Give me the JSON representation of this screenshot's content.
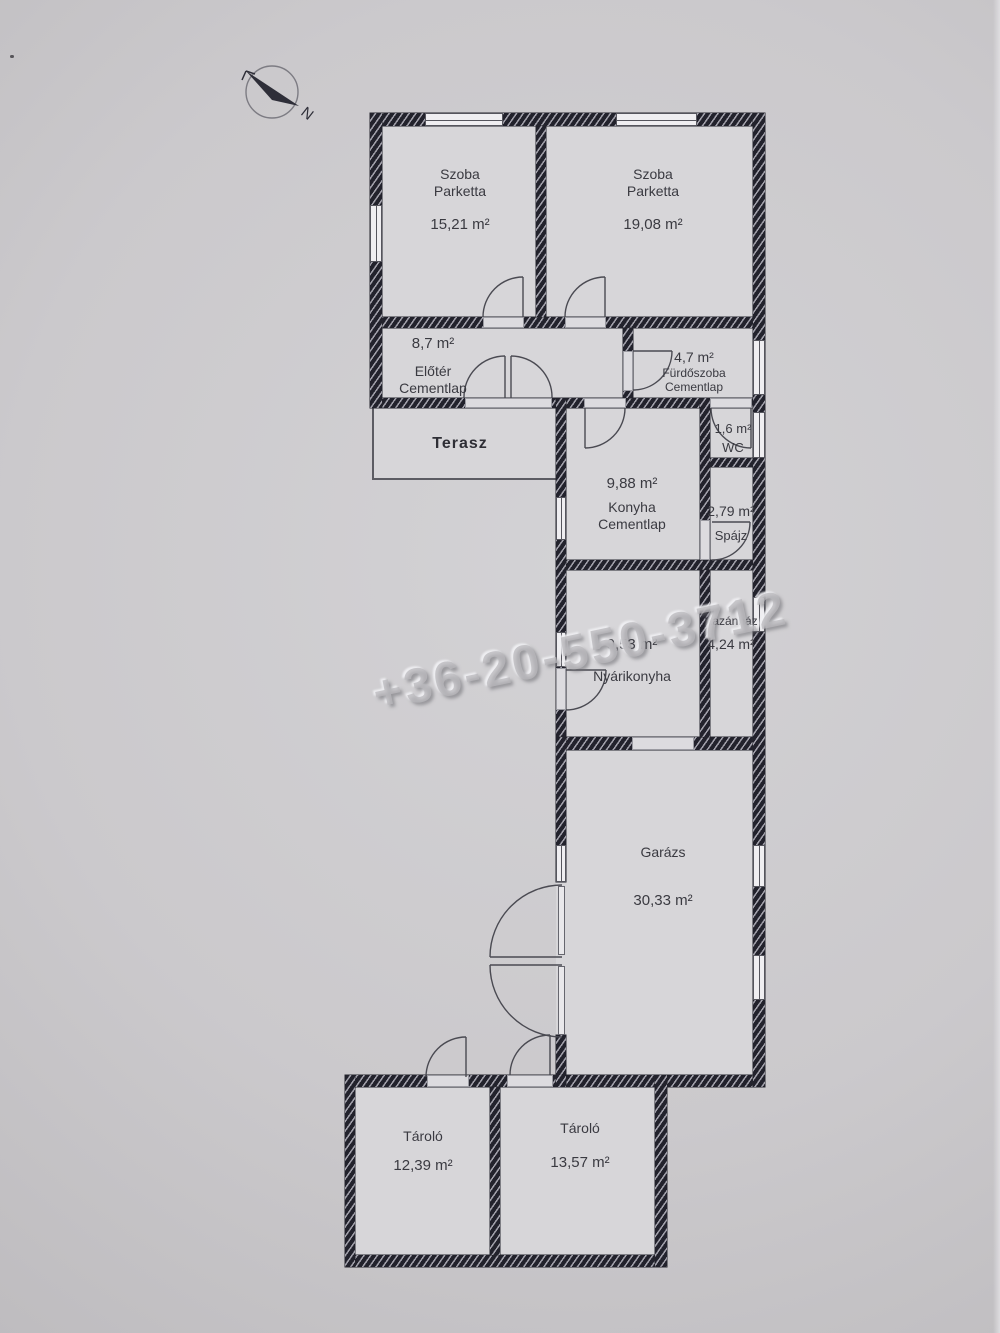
{
  "compass": {
    "label": "N"
  },
  "watermark": {
    "text": "+36-20-550-3712"
  },
  "rooms": {
    "szoba1": {
      "name": "Szoba",
      "floor": "Parketta",
      "area": "15,21 m²"
    },
    "szoba2": {
      "name": "Szoba",
      "floor": "Parketta",
      "area": "19,08 m²"
    },
    "eloter": {
      "area": "8,7 m²",
      "name": "Előtér",
      "floor": "Cementlap"
    },
    "furdoszoba": {
      "area": "4,7 m²",
      "name": "Fürdőszoba",
      "floor": "Cementlap"
    },
    "wc": {
      "area": "1,6 m²",
      "name": "WC"
    },
    "terasz": {
      "name": "Terasz"
    },
    "konyha": {
      "area": "9,88 m²",
      "name": "Konyha",
      "floor": "Cementlap"
    },
    "spajz": {
      "area": "2,79 m²",
      "name": "Spájz"
    },
    "nyarikonyha": {
      "area": "9,53 m²",
      "name": "Nyárikonyha"
    },
    "kazanhaz": {
      "name": "Kazánház",
      "area": "4,24 m²"
    },
    "garazs": {
      "name": "Garázs",
      "area": "30,33 m²"
    },
    "tarolo1": {
      "name": "Tároló",
      "area": "12,39 m²"
    },
    "tarolo2": {
      "name": "Tároló",
      "area": "13,57 m²"
    }
  }
}
